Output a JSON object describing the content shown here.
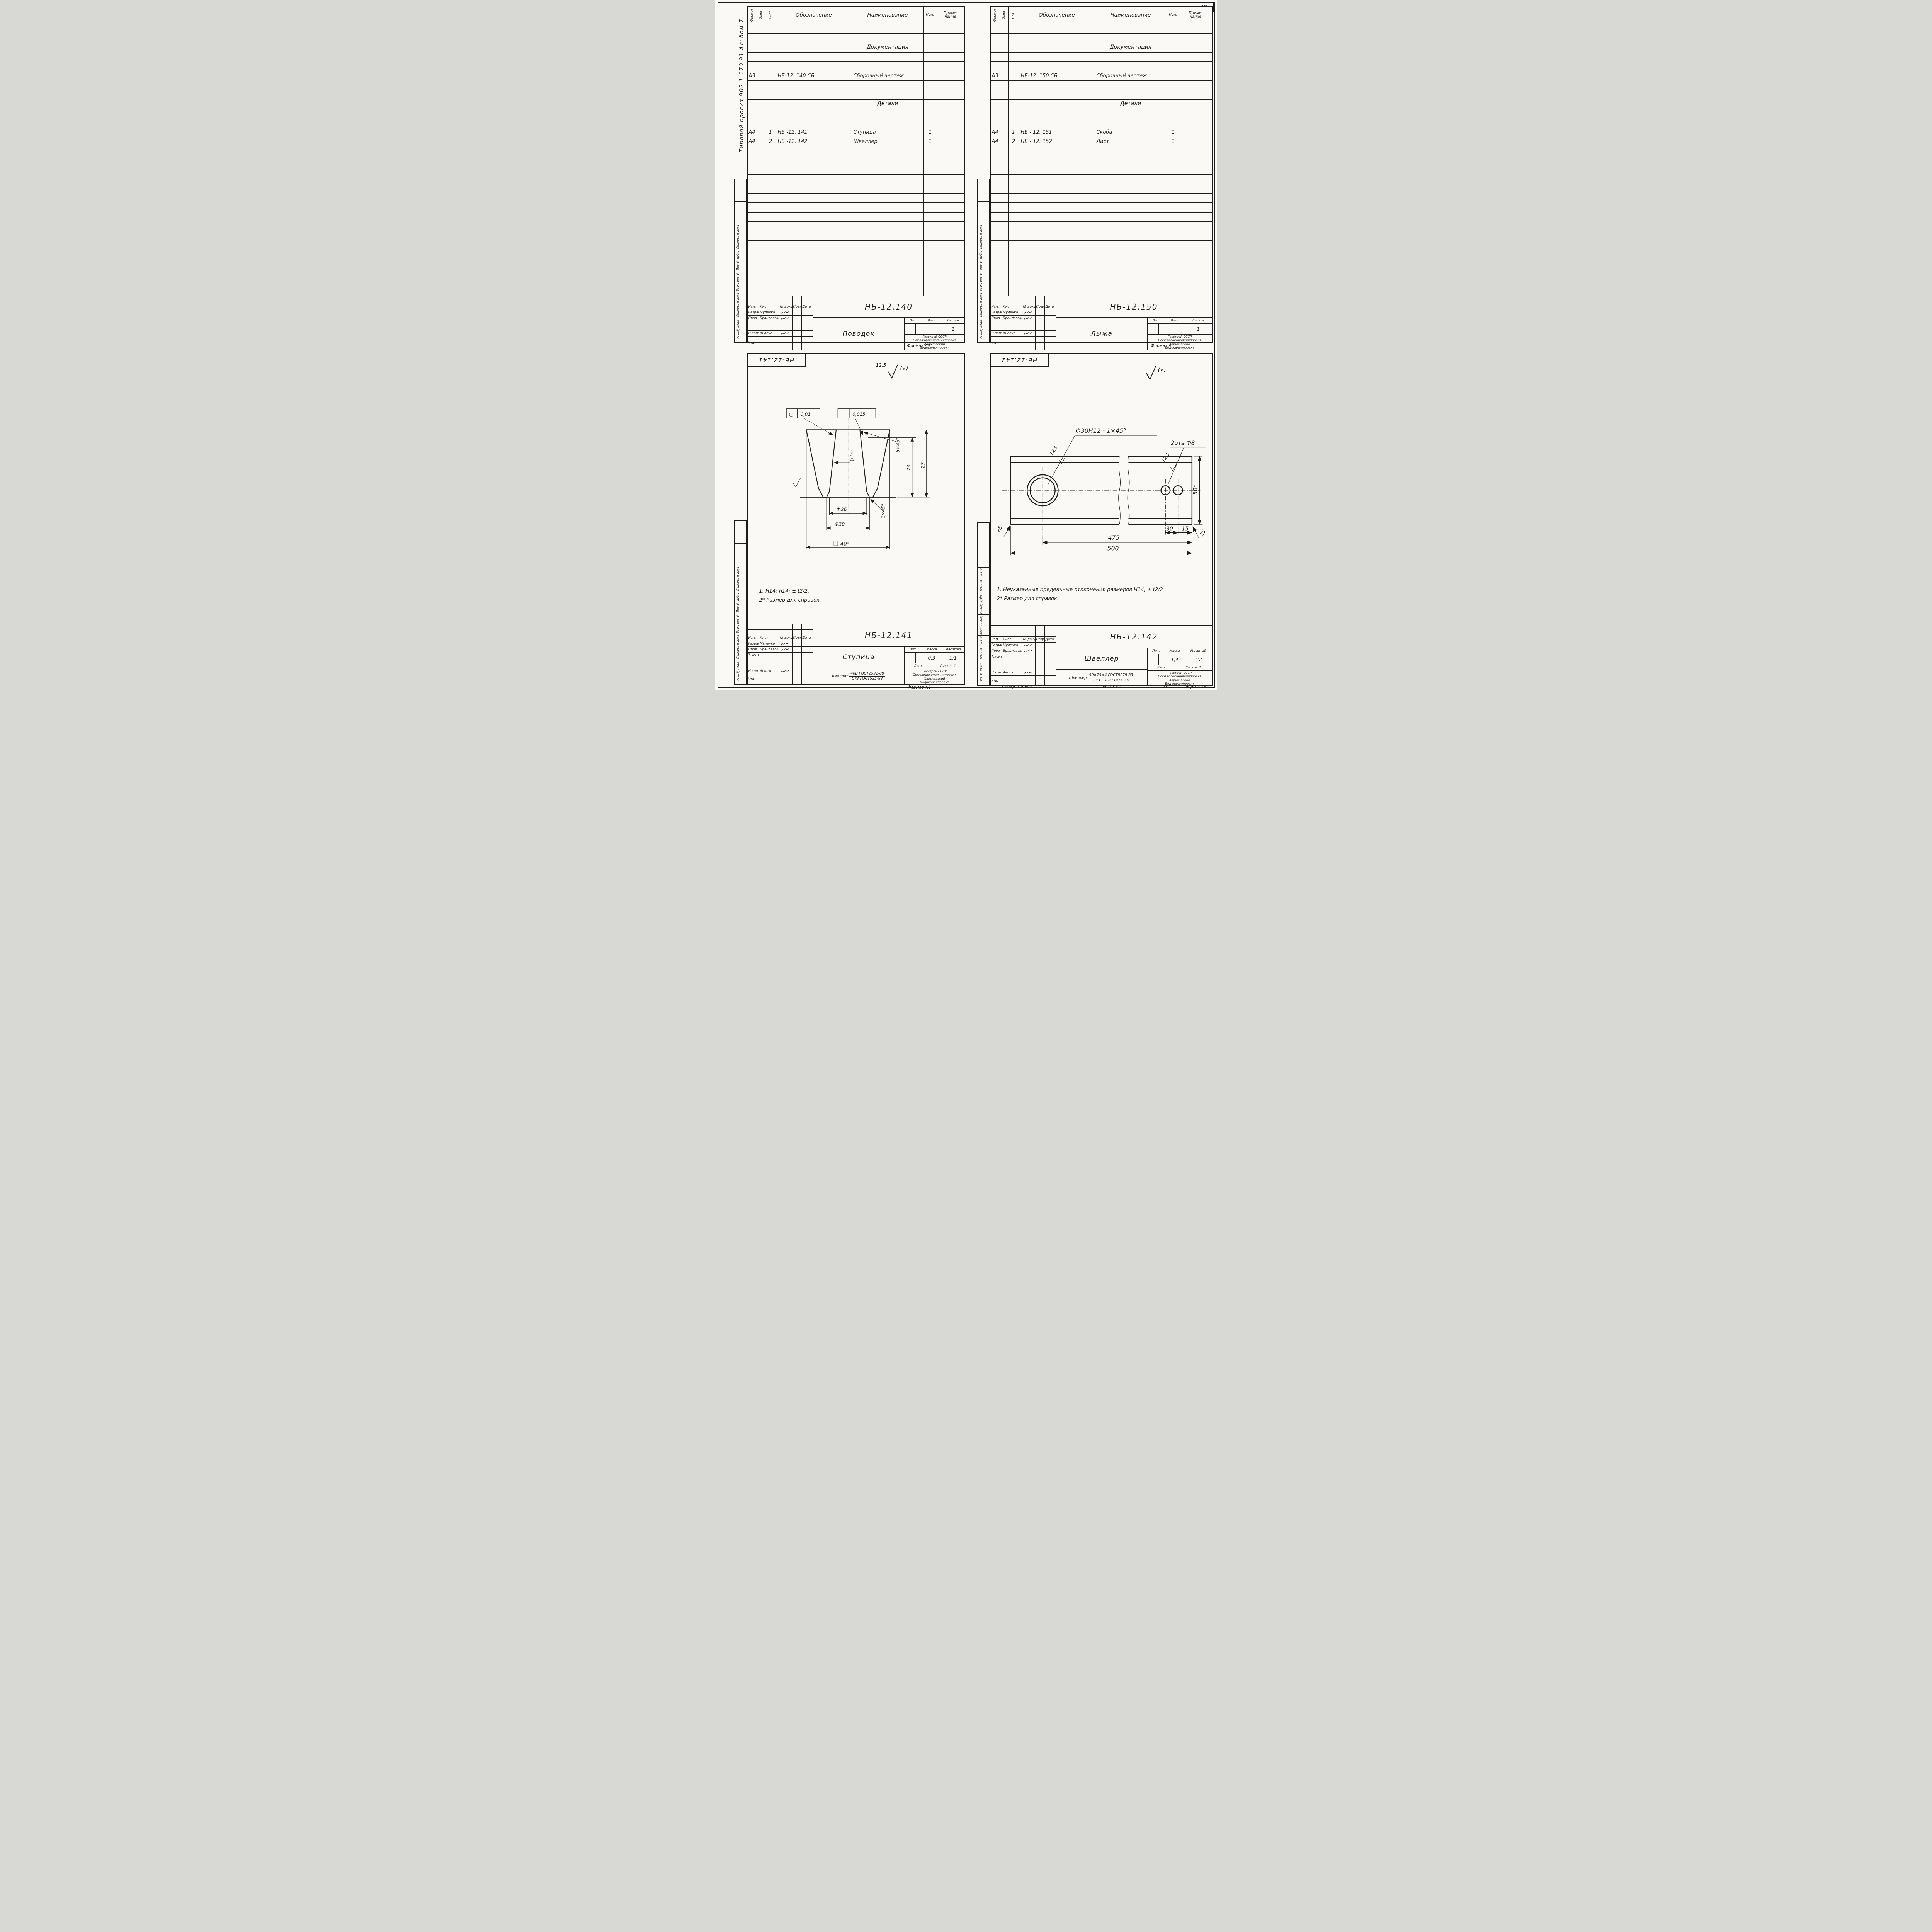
{
  "page": {
    "number": "40",
    "margin_note": "Типовой проект 902-1-170.91 Альбом 7",
    "format_note": "Формат А4",
    "footer": {
      "copier": "Копир Шелест",
      "order_no": "25017-07",
      "next_page": "41",
      "format": "ФорматА4"
    }
  },
  "stamp_strip": {
    "labels": [
      "Подпись и дата",
      "Инв.№ дубл.",
      "Взам. инв.№",
      "Подпись и дата",
      "Инв.№ подл."
    ]
  },
  "spec_columns": {
    "format": "Формат",
    "zone": "Зона",
    "designation": "Обозначение",
    "name": "Наименование",
    "qty": "Кол.",
    "note": "Приме-\nчание"
  },
  "tb": {
    "izm": "Изм.",
    "list": "Лист",
    "ndoc": "№ докум.",
    "sign": "Подп.",
    "date": "Дата",
    "razrab": "Разраб.",
    "prov": "Пров.",
    "tkontr": "Т.контр.",
    "nkontr": "Н.контр.",
    "utv": "Утв.",
    "lit": "Лит.",
    "mass": "Масса",
    "scale": "Масштаб",
    "sheet": "Лист",
    "sheets": "Листов",
    "org": "Госстрой СССР\nСоюзводоканалниипроект\nХарьковский\nВодоканалпроект"
  },
  "people": {
    "razrab": "Муленко",
    "prov": "Брацлавский",
    "nkontr": "Анопко"
  },
  "sheets": {
    "tl": {
      "doc": "НБ-12.140",
      "title": "Поводок",
      "pos_label": "Лист",
      "sheets_count": "1",
      "rows": [
        {
          "i": 2,
          "section": "Документация"
        },
        {
          "i": 5,
          "f": "А3",
          "d": "НБ-12. 140 СБ",
          "n": "Сборочный чертеж"
        },
        {
          "i": 8,
          "section": "Детали"
        },
        {
          "i": 11,
          "f": "А4",
          "p": "1",
          "d": "НБ -12. 141",
          "n": "Ступица",
          "q": "1"
        },
        {
          "i": 12,
          "f": "А4",
          "p": "2",
          "d": "НБ -12. 142",
          "n": "Швеллер",
          "q": "1"
        }
      ]
    },
    "tr": {
      "doc": "НБ-12.150",
      "title": "Лыжа",
      "pos_label": "Поз.",
      "sheets_count": "1",
      "rows": [
        {
          "i": 2,
          "section": "Документация"
        },
        {
          "i": 5,
          "f": "А3",
          "d": "НБ-12. 150 СБ",
          "n": "Сборочный чертеж"
        },
        {
          "i": 8,
          "section": "Детали"
        },
        {
          "i": 11,
          "f": "А4",
          "p": "1",
          "d": "НБ - 12. 151",
          "n": "Скоба",
          "q": "1"
        },
        {
          "i": 12,
          "f": "А4",
          "p": "2",
          "d": "НБ - 12. 152",
          "n": "Лист",
          "q": "1"
        }
      ]
    },
    "bl": {
      "doc": "НБ-12.141",
      "title": "Ступица",
      "mass": "0,3",
      "scale": "1:1",
      "sheets_count": "1",
      "material": {
        "label": "Квадрат",
        "top": "40В ГОСТ2591-88",
        "bottom": "Ст3 ГОСТ535-88"
      },
      "rough": {
        "value": "12,5",
        "rest": "(√)"
      },
      "notes": [
        "1. H14; h14; ± t2/2.",
        "2* Размер для справок."
      ],
      "dims": {
        "d26": "Ф26",
        "d30": "Ф30",
        "sq40": "40*",
        "h23": "23",
        "h27": "27",
        "ch5": "5×45°",
        "ch1": "1×45°",
        "taper": "▷1:5",
        "tol_round_sym": "○",
        "tol_round": "0,01",
        "tol_flat_sym": "—",
        "tol_flat": "0,015"
      }
    },
    "br": {
      "doc": "НБ-12.142",
      "title": "Швеллер",
      "mass": "1,4",
      "scale": "1:2",
      "sheets_count": "1",
      "material": {
        "label": "Швеллер",
        "top": "50×25×4 ГОСТ8278-83",
        "bottom": "Ст3 ГОСТ11474-76"
      },
      "rough": {
        "rest": "(√)"
      },
      "notes": [
        "1. Неуказанные предельные отклонения размеров Н14, ± t2/2",
        "2* Размер для справок."
      ],
      "dims": {
        "hole": "Ф30Н12 - 1×45°",
        "holes": "2отв.Ф8",
        "rough": "12,5",
        "l475": "475",
        "l500": "500",
        "s30": "30",
        "s15": "15",
        "w50": "50*",
        "edge": "25"
      }
    }
  }
}
